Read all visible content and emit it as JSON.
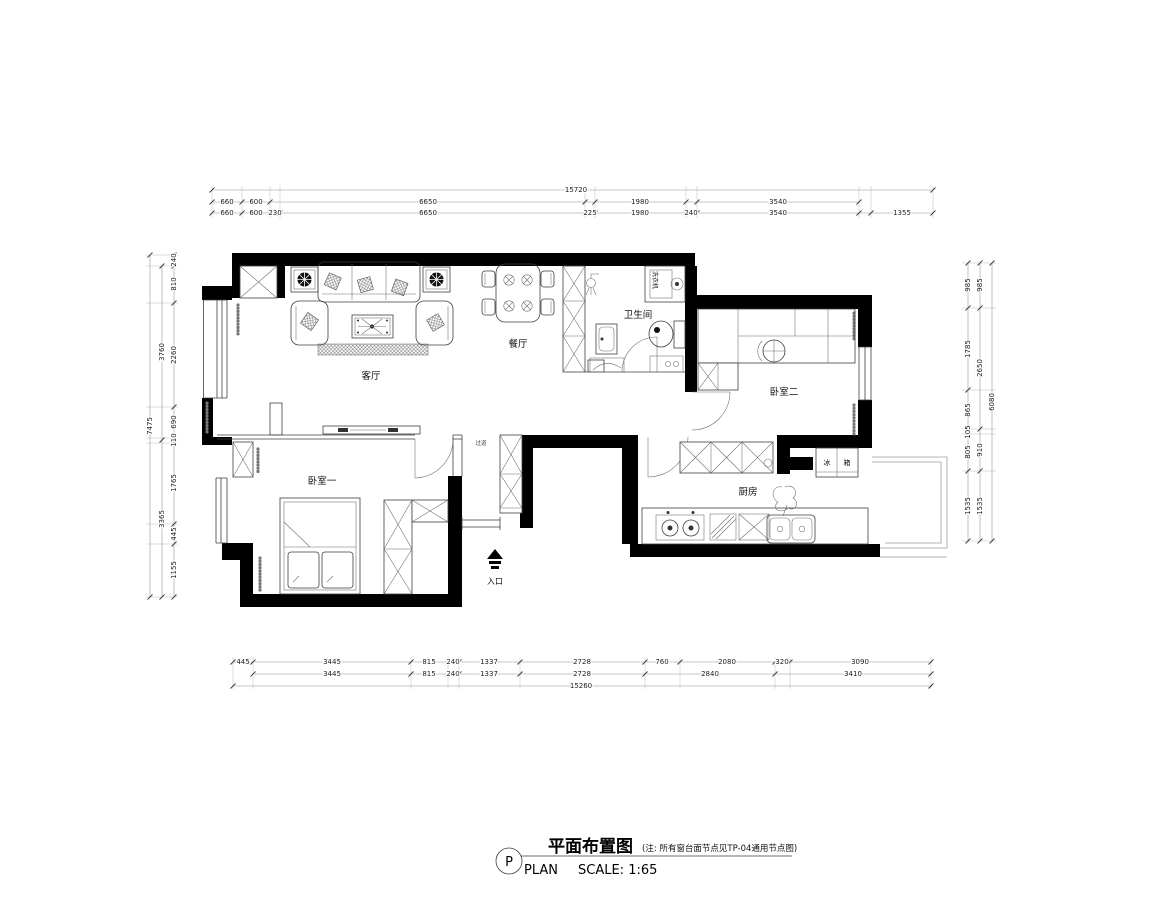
{
  "colors": {
    "wall": "#000000",
    "line": "#3f3f3f",
    "dim_text": "#1c1c1c",
    "paper": "#ffffff"
  },
  "dims": {
    "top_total": "15720",
    "top_row2": [
      "660",
      "600",
      "6650",
      "1980",
      "3540"
    ],
    "top_row3": [
      "660",
      "600",
      "230",
      "6650",
      "225",
      "1980",
      "240",
      "3540",
      "1355"
    ],
    "bottom_row1": [
      "445",
      "3445",
      "815",
      "240",
      "1337",
      "2728",
      "760",
      "2080",
      "320",
      "3090"
    ],
    "bottom_row2": [
      "3445",
      "815",
      "240",
      "1337",
      "2728",
      "2840",
      "3410"
    ],
    "bottom_total": "15260",
    "left_total": "7475",
    "left_mid": [
      "3760",
      "3365"
    ],
    "left_inner": [
      "240",
      "810",
      "2260",
      "690",
      "110",
      "1765",
      "445",
      "1155"
    ],
    "right_total": "6080",
    "right_mid": [
      "985",
      "2650",
      "910",
      "1535"
    ],
    "right_inner": [
      "985",
      "1785",
      "865",
      "105",
      "805",
      "1535"
    ]
  },
  "rooms": {
    "living": "客厅",
    "dining": "餐厅",
    "bathroom": "卫生间",
    "bedroom1": "卧室一",
    "bedroom2": "卧室二",
    "kitchen": "厨房",
    "hallway": "过道",
    "entrance": "入口"
  },
  "appliances": {
    "washer": "洗衣机",
    "fridge_left": "冰",
    "fridge_right": "箱"
  },
  "title": {
    "marker": "P",
    "title_cn": "平面布置图",
    "title_en": "PLAN",
    "scale": "SCALE:  1:65",
    "note": "(注: 所有窗台面节点见TP-04通用节点图)"
  }
}
